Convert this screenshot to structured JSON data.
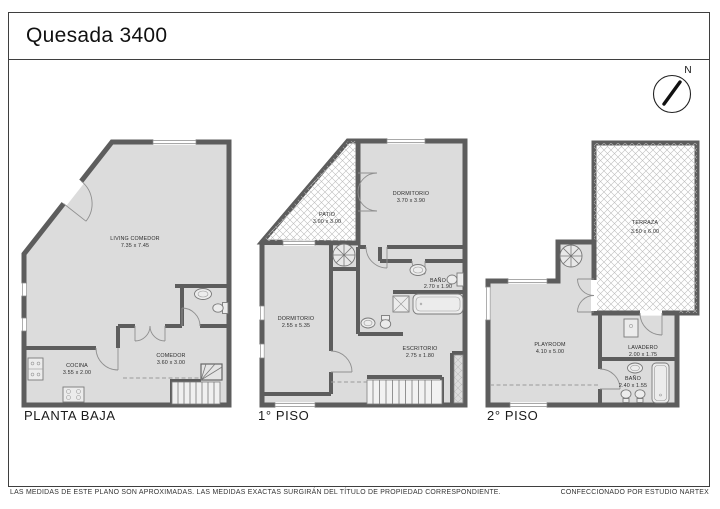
{
  "title": "Quesada 3400",
  "compass": {
    "north_label": "N"
  },
  "plans": [
    {
      "name": "PLANTA BAJA",
      "rooms": [
        {
          "name": "LIVING COMEDOR",
          "dims": "7.35 x 7.45"
        },
        {
          "name": "COCINA",
          "dims": "3.55 x 2.00"
        },
        {
          "name": "COMEDOR",
          "dims": "3.60 x 3.00"
        }
      ]
    },
    {
      "name": "1° PISO",
      "rooms": [
        {
          "name": "PATIO",
          "dims": "3.00 x 3.00"
        },
        {
          "name": "DORMITORIO",
          "dims": "3.70 x 3.90"
        },
        {
          "name": "BAÑO",
          "dims": "2.70 x 1.90"
        },
        {
          "name": "DORMITORIO",
          "dims": "2.55 x 5.35"
        },
        {
          "name": "ESCRITORIO",
          "dims": "2.75 x 1.80"
        }
      ]
    },
    {
      "name": "2° PISO",
      "rooms": [
        {
          "name": "TERRAZA",
          "dims": "3.50 x 6.00"
        },
        {
          "name": "PLAYROOM",
          "dims": "4.10 x 5.00"
        },
        {
          "name": "LAVADERO",
          "dims": "2.00 x 1.75"
        },
        {
          "name": "BAÑO",
          "dims": "2.40 x 1.55"
        }
      ]
    }
  ],
  "footer": {
    "left": "LAS MEDIDAS  DE ESTE PLANO SON APROXIMADAS. LAS MEDIDAS EXACTAS SURGIRÁN DEL TÍTULO DE PROPIEDAD CORRESPONDIENTE.",
    "right": "CONFECCIONADO POR ESTUDIO NARTEX"
  },
  "colors": {
    "wall": "#5d5d5d",
    "floor": "#dcdcdc",
    "hatch": "#bdbdbd"
  }
}
